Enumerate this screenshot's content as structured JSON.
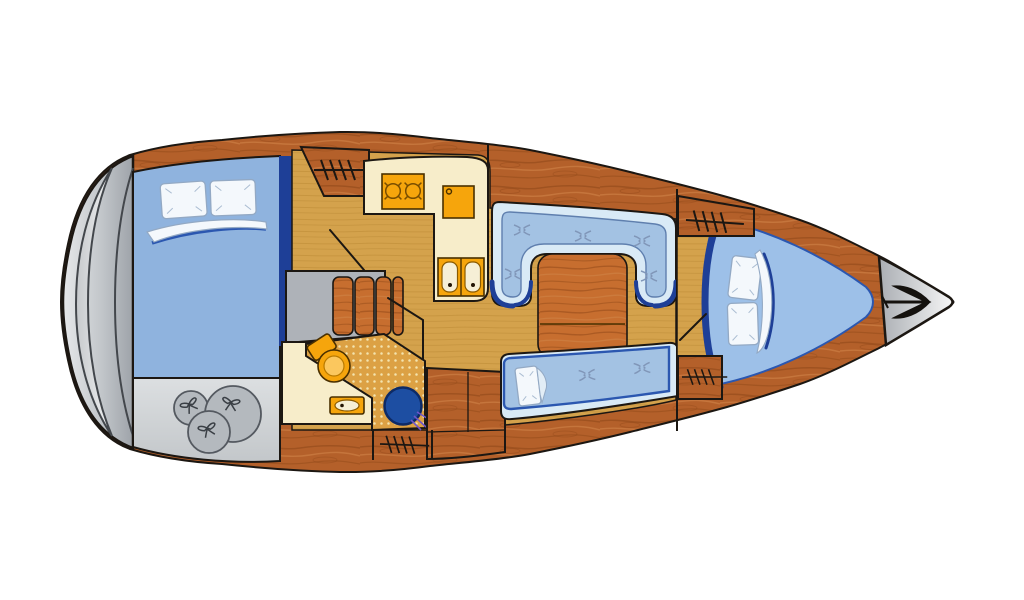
{
  "canvas": {
    "viewbox": "0 0 1024 600",
    "width": 1024,
    "height": 600,
    "background": "#ffffff"
  },
  "diagram": {
    "kind": "sailing-yacht-interior-floor-plan",
    "view": "top-down",
    "bow_direction": "right",
    "stern_direction": "left"
  },
  "colors": {
    "outline": "#1c1712",
    "wood": "#b4602a",
    "wood_dark": "#8a4315",
    "wood_light": "#d08448",
    "wood2": "#c76e2f",
    "floor": "#d4a24c",
    "floor_dark": "#bb8a35",
    "cream": "#f7edca",
    "orange": "#f6a50c",
    "orange_dark": "#7a4e00",
    "basin": "#f6efd6",
    "bed_blue": "#8fb3de",
    "cushion_blue": "#a3c2e3",
    "pale_blue": "#d9eaf6",
    "berth_blue": "#9dc0e8",
    "navy": "#1e3f97",
    "navy_light": "#2b57b0",
    "tuft": "#8096b8",
    "pillow": "#f4f8fc",
    "pillow_line": "#93a9c4",
    "gray_dark": "#43474c",
    "locker_gray": "#d3d6d9",
    "bag_gray": "#b4b9be",
    "steps_gray": "#aeb2b8",
    "shower": "#dca144",
    "shower_dot": "#f3e3ae",
    "drain": "#1d4ea2",
    "spray": "#6f55c8",
    "anchor": "#15120e"
  },
  "areas": {
    "stern_platform": {
      "icons": [
        "transom-steps-crescent"
      ]
    },
    "aft_cabin": {
      "icons": [
        "double-berth",
        "pillow",
        "pillow",
        "folded-sheet"
      ]
    },
    "aft_stowage": {
      "icons": [
        "sail-bag",
        "sail-bag",
        "sail-bag"
      ]
    },
    "companionway": {
      "icons": [
        "companionway-steps"
      ]
    },
    "wardrobes": {
      "icons": [
        "hanging-locker",
        "hanging-locker",
        "hanging-locker",
        "hanging-locker",
        "hanging-locker"
      ]
    },
    "galley": {
      "icons": [
        "two-burner-stove",
        "icebox",
        "double-sink"
      ]
    },
    "head": {
      "icons": [
        "toilet",
        "washbasin",
        "shower-floor",
        "shower-drain",
        "water-spray"
      ]
    },
    "salon": {
      "icons": [
        "u-settee",
        "saloon-table",
        "bench-settee",
        "pillow",
        "cushion-button",
        "cushion-button",
        "cushion-button",
        "cushion-button",
        "cushion-button",
        "cushion-button",
        "cushion-button"
      ]
    },
    "forward_cabin": {
      "icons": [
        "v-berth",
        "pillow",
        "pillow",
        "folded-sheet",
        "door-swing"
      ]
    },
    "anchor_locker": {
      "icons": [
        "anchor"
      ]
    }
  }
}
